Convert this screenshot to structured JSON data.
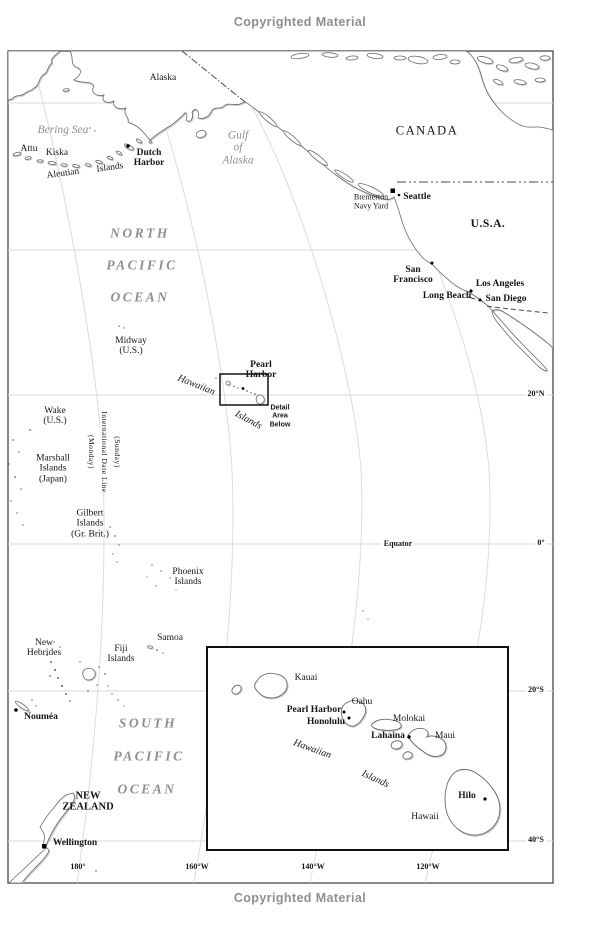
{
  "page": {
    "copyright_top": "Copyrighted Material",
    "copyright_bottom": "Copyrighted Material"
  },
  "colors": {
    "land_stroke": "#6a6a6a",
    "land_shadow": "#c9c9c9",
    "graticule": "#d9d9d9",
    "marker": "#000000",
    "label_text": "#141414",
    "ocean_label": "#8f8f8f",
    "copyright": "#8e8e8e"
  },
  "map": {
    "labels": [
      {
        "name": "label-alaska",
        "text": "Alaska",
        "x": 163,
        "y": 78,
        "cls": "place"
      },
      {
        "name": "label-bering-sea",
        "text": "Bering Sea",
        "x": 63,
        "y": 130,
        "cls": "ocean-sm"
      },
      {
        "name": "label-attu",
        "text": "Attu",
        "x": 29,
        "y": 149,
        "cls": "place"
      },
      {
        "name": "label-kiska",
        "text": "Kiska",
        "x": 57,
        "y": 153,
        "cls": "place"
      },
      {
        "name": "label-aleutian",
        "text": "Aleutian",
        "x": 63,
        "y": 174,
        "cls": "place",
        "rot": -8
      },
      {
        "name": "label-aleutian-islands",
        "text": "Islands",
        "x": 110,
        "y": 168,
        "cls": "place",
        "rot": -8
      },
      {
        "name": "label-dutch-harbor",
        "text": "Dutch\nHarbor",
        "x": 149,
        "y": 158,
        "cls": "port"
      },
      {
        "name": "label-gulf-of-alaska",
        "text": "Gulf\nof\nAlaska",
        "x": 238,
        "y": 148,
        "cls": "ocean-sm"
      },
      {
        "name": "label-canada",
        "text": "CANADA",
        "x": 427,
        "y": 131,
        "cls": "country"
      },
      {
        "name": "label-bremerton",
        "text": "Bremerton\nNavy Yard",
        "x": 371,
        "y": 202,
        "cls": "place-sm"
      },
      {
        "name": "label-seattle",
        "text": "Seattle",
        "x": 417,
        "y": 197,
        "cls": "port"
      },
      {
        "name": "label-usa",
        "text": "U.S.A.",
        "x": 488,
        "y": 224,
        "cls": "usa"
      },
      {
        "name": "label-north",
        "text": "NORTH",
        "x": 140,
        "y": 234,
        "cls": "ocean-lg"
      },
      {
        "name": "label-north-pacific",
        "text": "PACIFIC",
        "x": 142,
        "y": 266,
        "cls": "ocean-lg"
      },
      {
        "name": "label-north-ocean",
        "text": "OCEAN",
        "x": 140,
        "y": 298,
        "cls": "ocean-lg"
      },
      {
        "name": "label-san-francisco",
        "text": "San\nFrancisco",
        "x": 413,
        "y": 275,
        "cls": "port"
      },
      {
        "name": "label-los-angeles",
        "text": "Los Angeles",
        "x": 500,
        "y": 284,
        "cls": "port"
      },
      {
        "name": "label-long-beach",
        "text": "Long Beach",
        "x": 447,
        "y": 296,
        "cls": "port"
      },
      {
        "name": "label-san-diego",
        "text": "San Diego",
        "x": 506,
        "y": 299,
        "cls": "port"
      },
      {
        "name": "label-midway",
        "text": "Midway\n(U.S.)",
        "x": 131,
        "y": 346,
        "cls": "place"
      },
      {
        "name": "label-hawaiian-main",
        "text": "Hawaiian",
        "x": 196,
        "y": 386,
        "cls": "geo-rot",
        "rot": 22
      },
      {
        "name": "label-islands-main",
        "text": "Islands",
        "x": 248,
        "y": 421,
        "cls": "geo-rot",
        "rot": 28
      },
      {
        "name": "label-pearl-harbor-main",
        "text": "Pearl\nHarbor",
        "x": 261,
        "y": 370,
        "cls": "port"
      },
      {
        "name": "label-detail-area",
        "text": "Detail\nArea\nBelow",
        "x": 280,
        "y": 417,
        "cls": "detail"
      },
      {
        "name": "label-wake",
        "text": "Wake\n(U.S.)",
        "x": 55,
        "y": 416,
        "cls": "place"
      },
      {
        "name": "label-intl-date-line",
        "text": "International Date Line",
        "x": 104,
        "y": 452,
        "cls": "vtext"
      },
      {
        "name": "label-monday",
        "text": "(Monday)",
        "x": 91,
        "y": 452,
        "cls": "vtext"
      },
      {
        "name": "label-sunday",
        "text": "(Sunday)",
        "x": 117,
        "y": 452,
        "cls": "vtext"
      },
      {
        "name": "label-marshall",
        "text": "Marshall\nIslands\n(Japan)",
        "x": 53,
        "y": 469,
        "cls": "place"
      },
      {
        "name": "label-gilbert",
        "text": "Gilbert\nIslands\n(Gr. Brit.)",
        "x": 90,
        "y": 524,
        "cls": "place"
      },
      {
        "name": "label-equator",
        "text": "Equator",
        "x": 398,
        "y": 544,
        "cls": "lat"
      },
      {
        "name": "label-phoenix",
        "text": "Phoenix\nIslands",
        "x": 188,
        "y": 577,
        "cls": "place"
      },
      {
        "name": "label-samoa",
        "text": "Samoa",
        "x": 170,
        "y": 638,
        "cls": "place"
      },
      {
        "name": "label-new-hebrides",
        "text": "New\nHebrides",
        "x": 44,
        "y": 648,
        "cls": "place"
      },
      {
        "name": "label-fiji",
        "text": "Fiji\nIslands",
        "x": 121,
        "y": 654,
        "cls": "place"
      },
      {
        "name": "label-noumea",
        "text": "Nouméa",
        "x": 41,
        "y": 717,
        "cls": "port"
      },
      {
        "name": "label-south",
        "text": "SOUTH",
        "x": 148,
        "y": 724,
        "cls": "ocean-lg"
      },
      {
        "name": "label-south-pacific",
        "text": "PACIFIC",
        "x": 149,
        "y": 757,
        "cls": "ocean-lg"
      },
      {
        "name": "label-south-ocean",
        "text": "OCEAN",
        "x": 147,
        "y": 790,
        "cls": "ocean-lg"
      },
      {
        "name": "label-new-zealand",
        "text": "NEW\nZEALAND",
        "x": 88,
        "y": 802,
        "cls": "port-lg"
      },
      {
        "name": "label-wellington",
        "text": "Wellington",
        "x": 75,
        "y": 843,
        "cls": "port"
      },
      {
        "name": "label-20n",
        "text": "20°N",
        "x": 536,
        "y": 394,
        "cls": "lat"
      },
      {
        "name": "label-0",
        "text": "0°",
        "x": 541,
        "y": 543,
        "cls": "lat"
      },
      {
        "name": "label-20s",
        "text": "20°S",
        "x": 536,
        "y": 690,
        "cls": "lat"
      },
      {
        "name": "label-40s",
        "text": "40°S",
        "x": 536,
        "y": 840,
        "cls": "lat"
      },
      {
        "name": "label-180",
        "text": "180°",
        "x": 78,
        "y": 867,
        "cls": "lat"
      },
      {
        "name": "label-160w",
        "text": "160°W",
        "x": 197,
        "y": 867,
        "cls": "lat"
      },
      {
        "name": "label-140w",
        "text": "140°W",
        "x": 313,
        "y": 867,
        "cls": "lat"
      },
      {
        "name": "label-120w",
        "text": "120°W",
        "x": 428,
        "y": 867,
        "cls": "lat"
      },
      {
        "name": "label-inset-kauai",
        "text": "Kauai",
        "x": 306,
        "y": 678,
        "cls": "place"
      },
      {
        "name": "label-inset-oahu",
        "text": "Oahu",
        "x": 362,
        "y": 702,
        "cls": "place"
      },
      {
        "name": "label-inset-pearl-harbor",
        "text": "Pearl Harbor",
        "x": 314,
        "y": 710,
        "cls": "port"
      },
      {
        "name": "label-inset-honolulu",
        "text": "Honolulu",
        "x": 326,
        "y": 722,
        "cls": "port"
      },
      {
        "name": "label-inset-molokai",
        "text": "Molokai",
        "x": 409,
        "y": 719,
        "cls": "place"
      },
      {
        "name": "label-inset-lahaina",
        "text": "Lahaina",
        "x": 388,
        "y": 736,
        "cls": "port"
      },
      {
        "name": "label-inset-maui",
        "text": "Maui",
        "x": 445,
        "y": 736,
        "cls": "place"
      },
      {
        "name": "label-inset-hawaiian",
        "text": "Hawaiian",
        "x": 312,
        "y": 750,
        "cls": "geo-rot",
        "rot": 20
      },
      {
        "name": "label-inset-islands",
        "text": "Islands",
        "x": 375,
        "y": 780,
        "cls": "geo-rot",
        "rot": 25
      },
      {
        "name": "label-inset-hilo",
        "text": "Hilo",
        "x": 467,
        "y": 796,
        "cls": "port"
      },
      {
        "name": "label-inset-hawaii",
        "text": "Hawaii",
        "x": 425,
        "y": 817,
        "cls": "place"
      }
    ]
  }
}
